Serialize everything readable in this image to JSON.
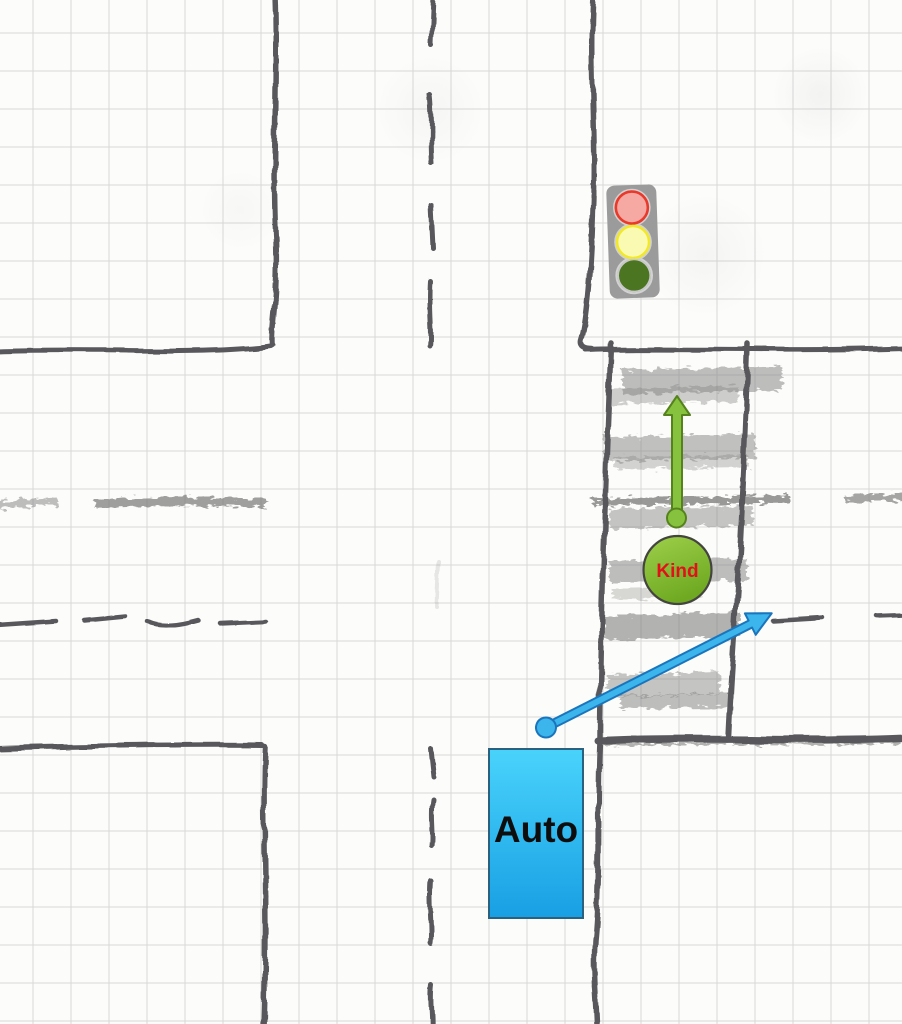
{
  "scene": {
    "description": "Hand-drawn sketch of a street intersection on squared paper with a traffic light, a zebra crosswalk, a child crossing and a car turning right",
    "markers": {
      "car_label": "Auto",
      "child_label": "Kind"
    },
    "traffic_light": {
      "body_color": "#9B9B9B",
      "lights": [
        {
          "name": "red",
          "fill": "#F5A9A2",
          "ring": "#E9392B"
        },
        {
          "name": "yellow",
          "fill": "#FAFAB2",
          "ring": "#F2E82B"
        },
        {
          "name": "green",
          "fill": "#4C7522",
          "ring": "#C9C9C9"
        }
      ]
    },
    "colors": {
      "car_fill_top": "#49D3FB",
      "car_fill_bottom": "#189FE4",
      "car_border": "#2C607F",
      "car_label_color": "#0D0D0D",
      "child_fill_top": "#9ED04B",
      "child_fill_bottom": "#6FA922",
      "child_border": "#45453F",
      "child_label_color": "#E3101B",
      "green_arrow_fill": "#86C23D",
      "green_arrow_border": "#55821C",
      "blue_arrow_fill": "#3BB5EB",
      "blue_arrow_border": "#1B75BC",
      "pencil": "#59595B",
      "graphite": "#80807F",
      "paper": "#FCFCFA",
      "grid": "#D8D8D8"
    }
  }
}
